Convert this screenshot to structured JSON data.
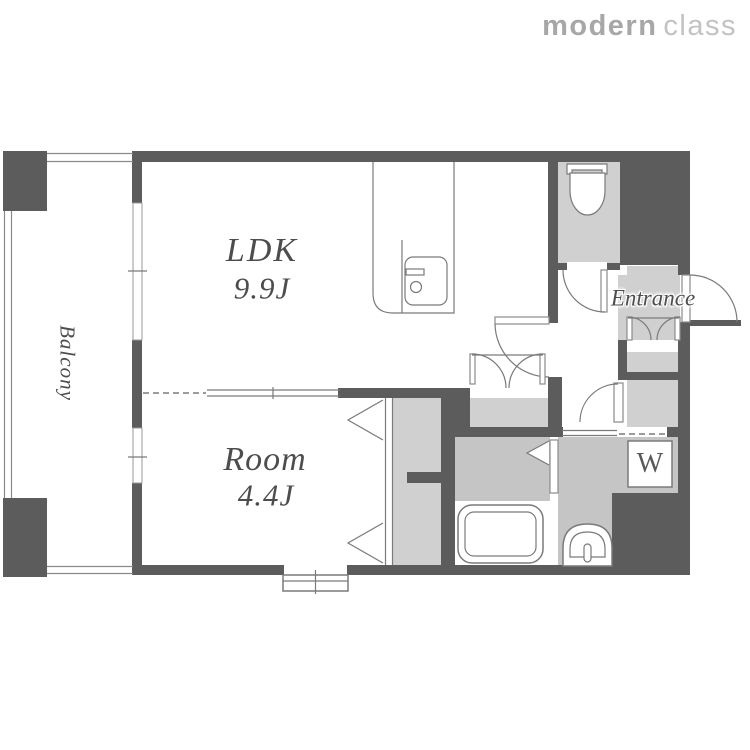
{
  "logo": {
    "bold": "modern",
    "light": "class"
  },
  "rooms": {
    "balcony": {
      "label": "Balcony"
    },
    "ldk": {
      "label": "LDK",
      "size": "9.9J"
    },
    "room": {
      "label": "Room",
      "size": "4.4J"
    },
    "entrance": {
      "label": "Entrance"
    },
    "washer": {
      "label": "W"
    }
  },
  "colors": {
    "wall": "#5c5c5c",
    "floor_light": "#d0d0d0",
    "floor_mid": "#c5c5c5",
    "outline": "#7a7a7a",
    "rail": "#8a8a8a",
    "text": "#4d4d4d",
    "logo_bold": "#a7a7a7",
    "logo_light": "#c2c2c2",
    "background": "#ffffff"
  }
}
